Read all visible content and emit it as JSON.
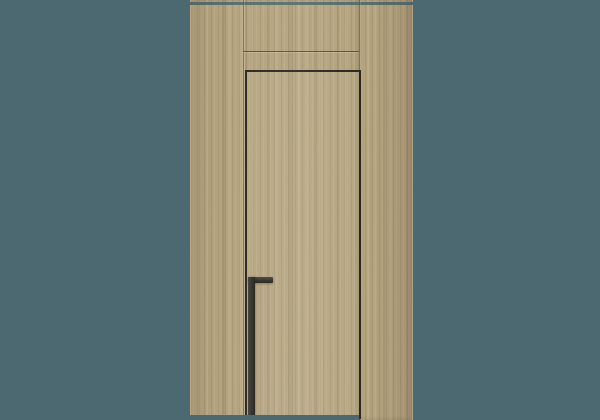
{
  "scene": {
    "type": "product-photo",
    "subject": "Concealed flush interior door in light oak vertical-grain veneer wall paneling with black L-shaped edge pull handle, on plain teal backdrop",
    "colors": {
      "background": "#4c6971",
      "wood_base": "#b4a37e",
      "wood_grain_dark": "#7a6846",
      "wood_grain_light": "#d6c89f",
      "door_gap": "#2d2922",
      "handle": "#37342f",
      "seam": "#605133"
    },
    "geometry": {
      "canvas": {
        "width": 600,
        "height": 420
      },
      "panel": {
        "x": 190,
        "y": 0,
        "width": 223,
        "height": 420
      },
      "ceiling_gap": {
        "y": 2,
        "height": 3
      },
      "left_seam_x": 243,
      "right_seam_x": 359,
      "transom_seam_y": 51,
      "door": {
        "x": 245,
        "y": 70,
        "width": 114,
        "bottom": 415,
        "gap_thickness": 2
      },
      "handle": {
        "x": 248,
        "y": 277,
        "stem_width": 7,
        "top_bar_length": 25,
        "top_bar_height": 6,
        "bottom": 415
      },
      "floor_gap": {
        "y": 415,
        "height": 5
      }
    }
  }
}
